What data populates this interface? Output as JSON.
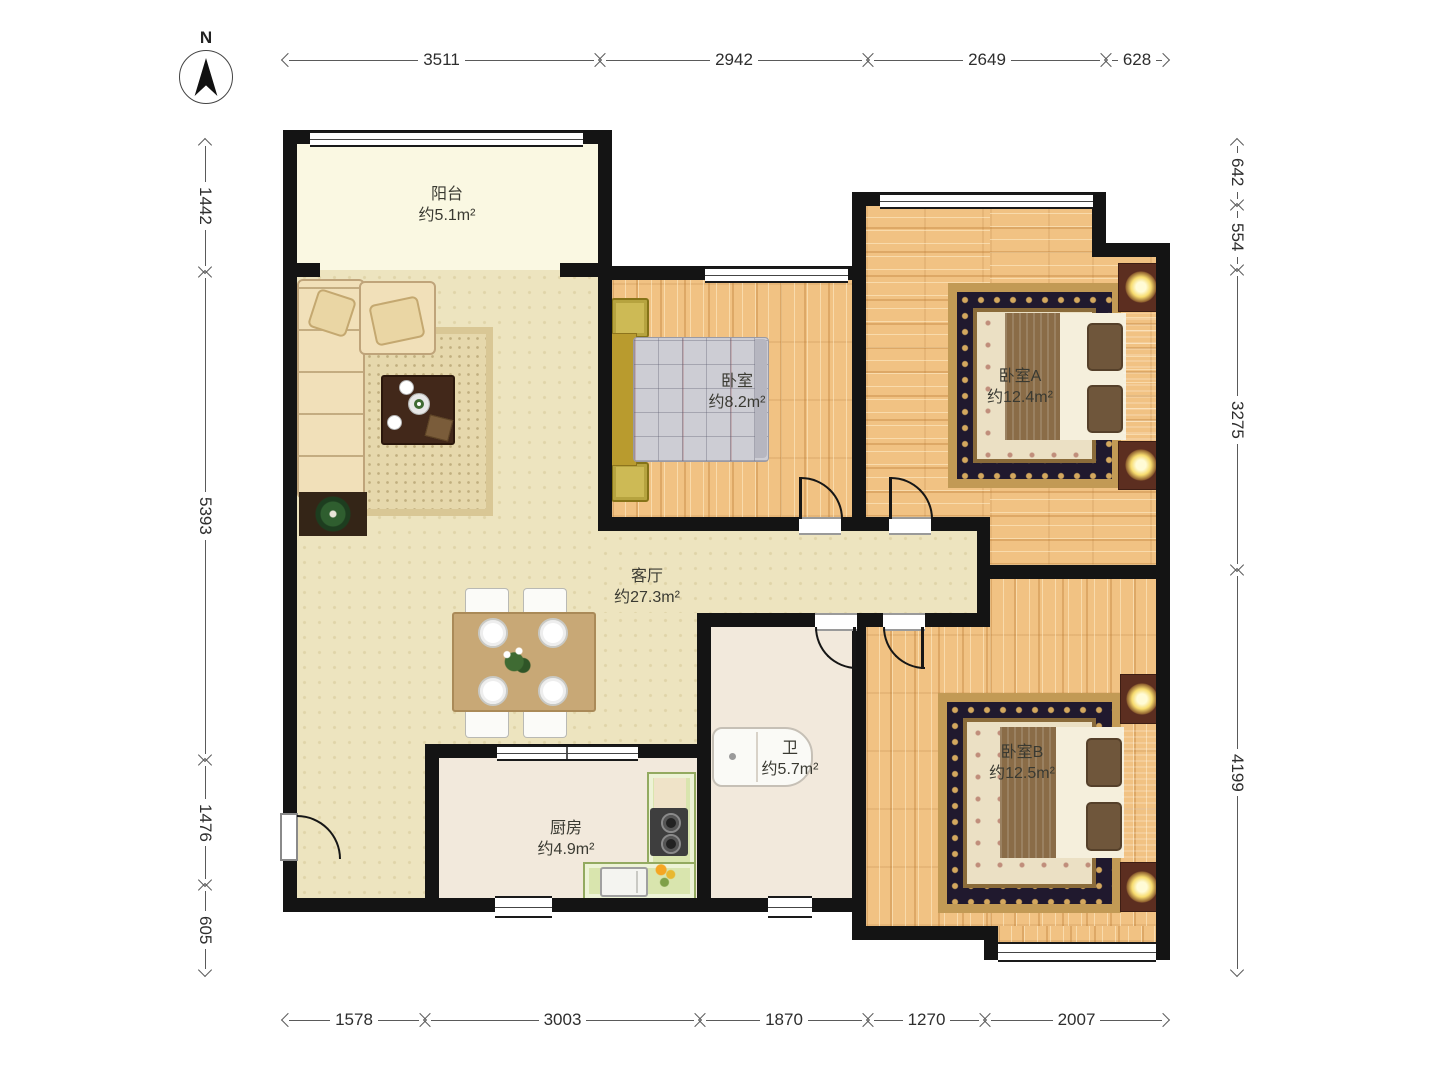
{
  "compass": {
    "label": "N"
  },
  "rooms": [
    {
      "id": "balcony",
      "name": "阳台",
      "area": "约5.1m²"
    },
    {
      "id": "bedroom",
      "name": "卧室",
      "area": "约8.2m²"
    },
    {
      "id": "bedroom-a",
      "name": "卧室A",
      "area": "约12.4m²"
    },
    {
      "id": "living-room",
      "name": "客厅",
      "area": "约27.3m²"
    },
    {
      "id": "bathroom",
      "name": "卫",
      "area": "约5.7m²"
    },
    {
      "id": "kitchen",
      "name": "厨房",
      "area": "约4.9m²"
    },
    {
      "id": "bedroom-b",
      "name": "卧室B",
      "area": "约12.5m²"
    }
  ],
  "dimensions": {
    "top": [
      "3511",
      "2942",
      "2649",
      "628"
    ],
    "bottom": [
      "1578",
      "3003",
      "1870",
      "1270",
      "2007"
    ],
    "left": [
      "1442",
      "5393",
      "1476",
      "605"
    ],
    "right": [
      "642",
      "554",
      "3275",
      "4199"
    ]
  },
  "colors": {
    "wall": "#141414",
    "wood_floor": "#F1C283",
    "living_floor": "#EDE4BF",
    "balcony_floor": "#FAF8E2",
    "service_floor": "#F2E9DC",
    "kitchen_counter": "#D9E5AE",
    "rug_dark": "#20192E",
    "rug_gold": "#C29A55"
  }
}
